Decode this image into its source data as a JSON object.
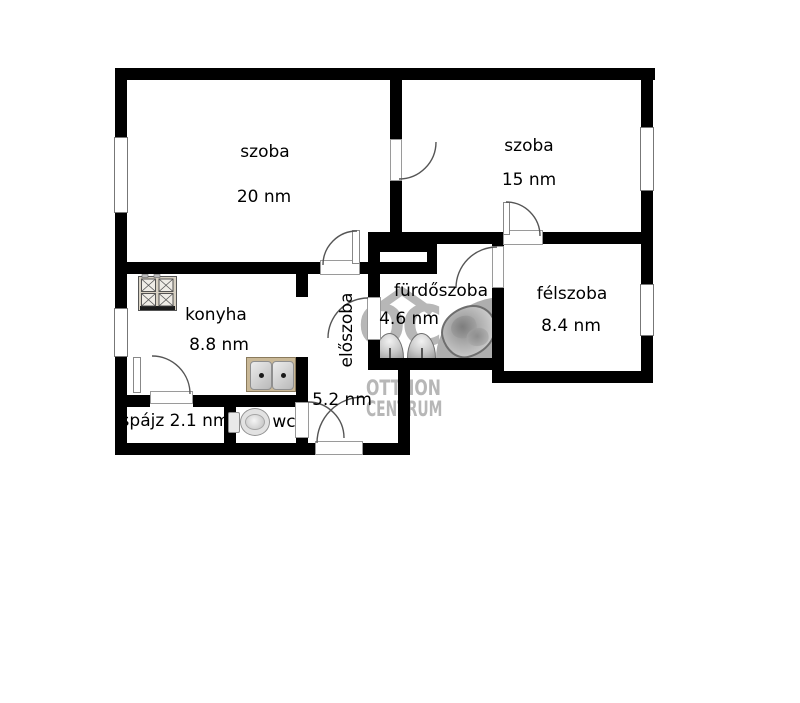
{
  "plan": {
    "rooms": {
      "szoba20": {
        "name": "szoba",
        "area": "20 nm"
      },
      "szoba15": {
        "name": "szoba",
        "area": "15 nm"
      },
      "konyha": {
        "name": "konyha",
        "area": "8.8 nm"
      },
      "furdoszoba": {
        "name": "fürdőszoba",
        "area": "4.6 nm"
      },
      "felszoba": {
        "name": "félszoba",
        "area": "8.4 nm"
      },
      "eloszoba": {
        "name": "előszoba",
        "area": "5.2 nm"
      },
      "spajz": {
        "name": "spájz 2.1 nm"
      },
      "wc": {
        "name": "wc"
      }
    }
  },
  "watermark": {
    "logo": "OC",
    "line1": "OTTHON",
    "line2": "CENTRUM"
  },
  "colors": {
    "wall": "#000000",
    "watermark_gray": "#b7b7b7",
    "stove_frame": "#d8d1c3",
    "counter_tan": "#c9b897",
    "fixture_gray": "#bfbfbf",
    "tub_platform": "#aeaeae"
  },
  "icons": {
    "stove": "stove-icon",
    "kitchen_sink": "kitchen-sink-icon",
    "toilet": "toilet-icon",
    "washbasin": "washbasin-icon",
    "bathtub": "bathtub-icon",
    "logo_roof": "house-roof-icon"
  }
}
